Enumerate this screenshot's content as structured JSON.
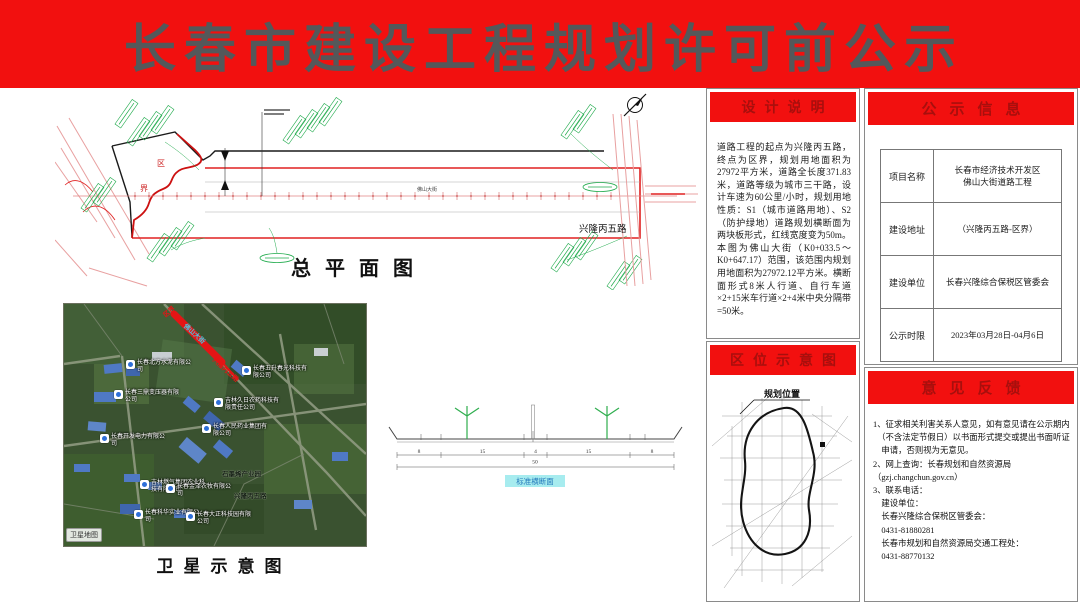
{
  "banner": {
    "title": "长春市建设工程规划许可前公示"
  },
  "colors": {
    "banner_red": "#f2100f",
    "boundary_red": "#e02020",
    "annotation_green": "#1faa4b",
    "centerline_pink": "#e08585"
  },
  "site_plan": {
    "caption": "总平面图",
    "road_label": "兴隆丙五路",
    "boundary_char_1": "区",
    "boundary_char_2": "界",
    "street_note": "佛山大街"
  },
  "satellite": {
    "caption": "卫星示意图",
    "watermark": "卫星地图",
    "overlay_labels": [
      {
        "text": "区界",
        "x": 98,
        "y": 2,
        "color": "#e31515",
        "rotate": -40
      },
      {
        "text": "佛山大街",
        "x": 118,
        "y": 24,
        "color": "#49c8e0",
        "rotate": 42
      },
      {
        "text": "兴隆丙五路",
        "x": 146,
        "y": 60,
        "color": "#e31515",
        "rotate": 42
      }
    ],
    "pins": [
      {
        "x": 62,
        "y": 56,
        "label": "长春北方水泥有限公司"
      },
      {
        "x": 178,
        "y": 62,
        "label": "长春五升春光科技有限公司"
      },
      {
        "x": 150,
        "y": 94,
        "label": "吉林久日农药科技有限责任公司"
      },
      {
        "x": 138,
        "y": 120,
        "label": "长春人民药业集团有限公司"
      },
      {
        "x": 50,
        "y": 86,
        "label": "长春三鼎变压器有限公司"
      },
      {
        "x": 36,
        "y": 130,
        "label": "长春开发电力有限公司"
      },
      {
        "x": 76,
        "y": 176,
        "label": "吉林燃气集团农业科技有限公司"
      },
      {
        "x": 102,
        "y": 180,
        "label": "长春金泽农牧有限公司"
      },
      {
        "x": 70,
        "y": 206,
        "label": "长春科华实业有限公司"
      },
      {
        "x": 122,
        "y": 208,
        "label": "长春大正科技园有限公司"
      }
    ],
    "area_labels": [
      {
        "text": "石墨烯产业园",
        "x": 158,
        "y": 164
      },
      {
        "text": "兴隆丙五路",
        "x": 170,
        "y": 186
      }
    ]
  },
  "cross_section": {
    "label": "标准横断面",
    "dims": [
      "8",
      "15",
      "4",
      "15",
      "8"
    ],
    "total": "50"
  },
  "panels": {
    "design": {
      "title": "设计说明",
      "body": "道路工程的起点为兴隆丙五路，终点为区界，规划用地面积为27972平方米，道路全长度371.83米，道路等级为城市三干路，设计车速为60公里/小时，规划用地性质：S1（城市道路用地）、S2（防护绿地）道路规划横断面为两块板形式，红线宽度变为50m。本图为佛山大街（K0+033.5～K0+647.17）范围，该范围内规划用地面积为27972.12平方米。横断面形式8米人行道、自行车道×2+15米车行道×2+4米中央分隔带=50米。"
    },
    "location": {
      "title": "区位示意图",
      "map_label": "规划位置"
    },
    "notice": {
      "title": "公示信息",
      "rows": [
        {
          "label": "项目名称",
          "value": "长春市经济技术开发区\n佛山大街道路工程"
        },
        {
          "label": "建设地址",
          "value": "（兴隆丙五路-区界）"
        },
        {
          "label": "建设单位",
          "value": "长春兴隆综合保税区管委会"
        },
        {
          "label": "公示时限",
          "value": "2023年03月28日-04月6日"
        }
      ]
    },
    "feedback": {
      "title": "意见反馈",
      "lines": [
        "1、征求相关利害关系人意见，如有意见请在公示期内",
        "　（不含法定节假日）以书面形式提交或提出书面听证",
        "　申请，否则视为无意见。",
        "2、网上查询：长春规划和自然资源局（gzj.changchun.gov.cn）",
        "3、联系电话：",
        "　建设单位：",
        "　长春兴隆综合保税区管委会：",
        "　0431-81880281",
        "　长春市规划和自然资源局交通工程处：",
        "　0431-88770132"
      ]
    }
  }
}
